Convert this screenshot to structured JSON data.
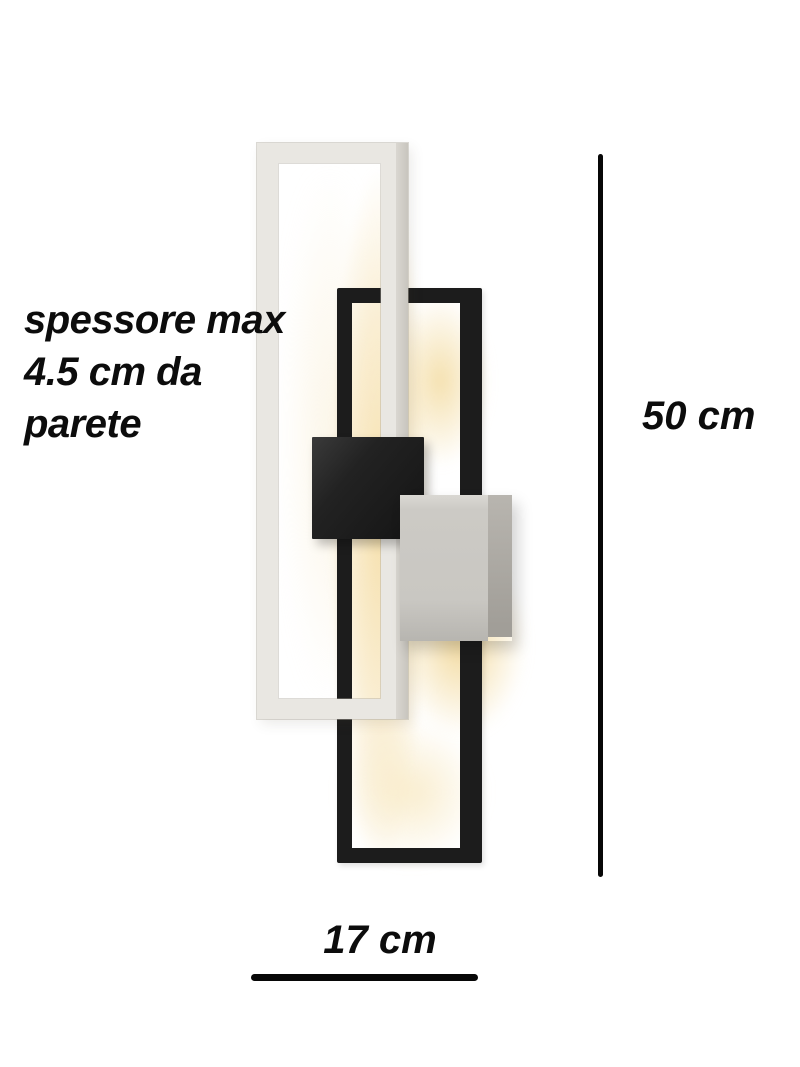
{
  "image": {
    "type": "product-dimension-diagram",
    "subject": "LED wall lamp with two overlapping rectangular light frames",
    "background_color": "#ffffff"
  },
  "annotations": {
    "thickness_note": {
      "lines": [
        "spessore max",
        "4.5 cm da",
        "parete"
      ],
      "text_color": "#0c0c0c"
    },
    "height_dimension": {
      "label": "50 cm"
    },
    "width_dimension": {
      "label": "17 cm"
    }
  },
  "lamp": {
    "white_frame_color": "#e9e7e2",
    "black_frame_color": "#1c1c1c",
    "black_mount_block_color": "#1f1f1f",
    "silver_mount_block_color": "#c9c7c2",
    "led_glow_color": "#f3dda8"
  }
}
